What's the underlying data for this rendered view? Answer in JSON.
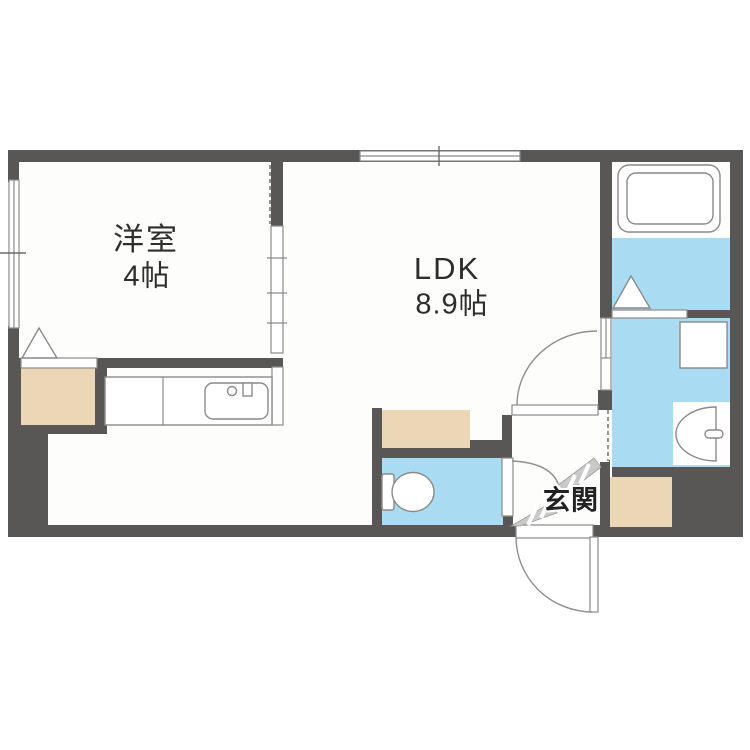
{
  "floorplan": {
    "title": "1LDK apartment floor plan",
    "labels": {
      "western_room_name": "洋室",
      "western_room_size": "4帖",
      "ldk_name": "LDK",
      "ldk_size": "8.9帖",
      "entrance": "玄関"
    },
    "rooms": [
      {
        "name": "洋室",
        "size": "4帖"
      },
      {
        "name": "LDK",
        "size": "8.9帖"
      },
      {
        "name": "玄関",
        "size": ""
      }
    ],
    "fixtures": [
      "bathtub",
      "bathroom-floor",
      "washroom",
      "washing-machine-pan",
      "wash-basin",
      "toilet",
      "kitchen-counter",
      "kitchen-sink",
      "closet",
      "storage",
      "entrance-porch"
    ],
    "colors": {
      "wall": "#595755",
      "water": "#a9dbf3",
      "storage": "#ebd7b6",
      "floor": "#fdfdfc",
      "line": "#8a8a8a"
    }
  }
}
